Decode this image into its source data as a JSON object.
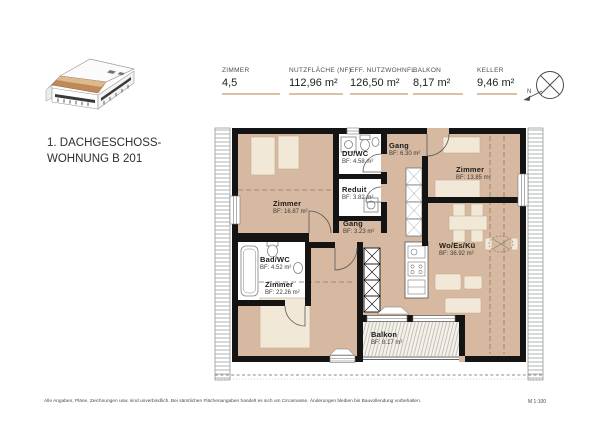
{
  "title": {
    "line1": "1. DACHGESCHOSS-",
    "line2": "WOHNUNG B 201"
  },
  "metrics": [
    {
      "label": "ZIMMER",
      "value": "4,5"
    },
    {
      "label": "NUTZFLÄCHE (NF)",
      "value": "112,96 m²"
    },
    {
      "label": "EFF. NUTZWOHNFL.",
      "value": "126,50 m²"
    },
    {
      "label": "BALKON",
      "value": "8,17 m²"
    },
    {
      "label": "KELLER",
      "value": "9,46 m²"
    }
  ],
  "rooms": [
    {
      "name": "Zimmer",
      "area": "BF: 16.87 m²"
    },
    {
      "name": "DU/WC",
      "area": "BF: 4.58 m²"
    },
    {
      "name": "Gang",
      "area": "BF: 6.30 m²"
    },
    {
      "name": "Zimmer",
      "area": "BF: 13.85 m²"
    },
    {
      "name": "Reduit",
      "area": "BF: 3.82 m²"
    },
    {
      "name": "Gang",
      "area": "BF: 3.23 m²"
    },
    {
      "name": "Bad/WC",
      "area": "BF: 4.52 m²"
    },
    {
      "name": "Zimmer",
      "area": "BF: 22.26 m²"
    },
    {
      "name": "Wo/Es/Kü",
      "area": "BF: 36.92 m²"
    },
    {
      "name": "Balkon",
      "area": "BF: 8.17 m²"
    }
  ],
  "compass": {
    "label": "N"
  },
  "footer": {
    "disclaimer": "Alle Angaben, Pläne, Zeichnungen usw. sind unverbindlich. Bei sämtlichen Flächenangaben handelt es sich um Circamasse. Änderungen bleiben bis Bauvollendung vorbehalten.",
    "scale": "M 1:100"
  },
  "colors": {
    "floor_tan": "#d6b9a0",
    "furniture": "#f1e8d8",
    "wall": "#141414",
    "underline_accent": "#d8c2a2",
    "roof_brown": "#c08a58"
  }
}
